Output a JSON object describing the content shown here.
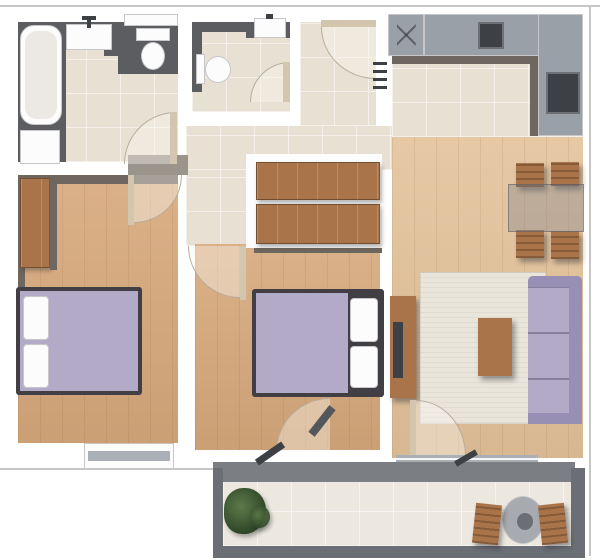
{
  "palette": {
    "plot_line": "#c6c6c6",
    "tile": "#e8e0d3",
    "tile_dark": "#9a948a",
    "wood_living": "#e3c29a",
    "wood_bed": "#d6a87b",
    "shadow": "#5c5d61",
    "shadow_soft": "#6e675f",
    "white_fix": "#fcfcfc",
    "tub_inner": "#ece9e4",
    "appliance_dark": "#3d4146",
    "counter": "#9aa0a8",
    "furn_wood": "#aa744a",
    "bed_frame": "#413f44",
    "purple": "#b2aac7",
    "purple_dark": "#9890b4",
    "rug": "#e9e5da",
    "balcony_floor": "#ece8e0",
    "balc_shadow": "#7b7e83",
    "railing": "#6b6f75",
    "window_gray": "#aab0b6",
    "balc_table": "#a7aaae",
    "door_arc": "#b9ad9c",
    "door_leaf": "#d2c6ae",
    "door_leaf_dark": "#54575b",
    "plant_green": "#3d5a35"
  },
  "scene": {
    "shapes": [
      {
        "name": "plot-line-top",
        "x": 0,
        "y": 5,
        "w": 600,
        "h": 2,
        "fill": "plot_line"
      },
      {
        "name": "plot-line-right",
        "x": 589,
        "y": 5,
        "w": 2,
        "h": 551,
        "fill": "plot_line"
      },
      {
        "name": "plot-line-bottom-left",
        "x": 0,
        "y": 468,
        "w": 214,
        "h": 2,
        "fill": "plot_line"
      },
      {
        "name": "bathroom-floor",
        "x": 18,
        "y": 22,
        "w": 160,
        "h": 140,
        "fill": "tile",
        "cls": "tile"
      },
      {
        "name": "wc-floor",
        "x": 192,
        "y": 22,
        "w": 98,
        "h": 90,
        "fill": "tile",
        "cls": "tile"
      },
      {
        "name": "hall-entry-floor",
        "x": 300,
        "y": 22,
        "w": 76,
        "h": 104,
        "fill": "tile",
        "cls": "tile"
      },
      {
        "name": "hall-mid-floor",
        "x": 186,
        "y": 126,
        "w": 206,
        "h": 44,
        "fill": "tile",
        "cls": "tile"
      },
      {
        "name": "hall-south-floor",
        "x": 186,
        "y": 170,
        "w": 60,
        "h": 76,
        "fill": "tile",
        "cls": "tile"
      },
      {
        "name": "vestibule-floor",
        "x": 128,
        "y": 155,
        "w": 60,
        "h": 20,
        "fill": "tile_dark"
      },
      {
        "name": "kitchen-floor",
        "x": 392,
        "y": 22,
        "w": 191,
        "h": 115,
        "fill": "tile",
        "cls": "tile"
      },
      {
        "name": "living-room-floor",
        "x": 392,
        "y": 137,
        "w": 191,
        "h": 321,
        "fill": "wood_living",
        "cls": "wood-v"
      },
      {
        "name": "bedroom1-floor",
        "x": 18,
        "y": 175,
        "w": 160,
        "h": 268,
        "fill": "wood_bed",
        "cls": "wood-v"
      },
      {
        "name": "bedroom2-floor",
        "x": 195,
        "y": 244,
        "w": 185,
        "h": 206,
        "fill": "wood_bed",
        "cls": "wood-v"
      },
      {
        "name": "bathroom-top-shadow",
        "x": 18,
        "y": 22,
        "w": 160,
        "h": 10,
        "fill": "shadow"
      },
      {
        "name": "bathtub-base-shadow",
        "x": 18,
        "y": 22,
        "w": 48,
        "h": 140,
        "fill": "shadow"
      },
      {
        "name": "sink-nook-shadow",
        "x": 60,
        "y": 22,
        "w": 62,
        "h": 12,
        "fill": "shadow"
      },
      {
        "name": "sink-side-shadow",
        "x": 104,
        "y": 22,
        "w": 18,
        "h": 34,
        "fill": "shadow"
      },
      {
        "name": "toilet-nook-shadow",
        "x": 118,
        "y": 24,
        "w": 60,
        "h": 50,
        "fill": "shadow"
      },
      {
        "name": "toilet-shelf",
        "x": 124,
        "y": 14,
        "w": 54,
        "h": 12,
        "fill": "white_fix",
        "cls": "fixture"
      },
      {
        "name": "wc-top-shadow",
        "x": 192,
        "y": 22,
        "w": 98,
        "h": 10,
        "fill": "shadow"
      },
      {
        "name": "wc-left-shadow",
        "x": 192,
        "y": 22,
        "w": 10,
        "h": 70,
        "fill": "shadow"
      },
      {
        "name": "wc-sink-nook-shadow",
        "x": 246,
        "y": 22,
        "w": 44,
        "h": 16,
        "fill": "shadow"
      },
      {
        "name": "kitchen-counter-shadow",
        "x": 392,
        "y": 54,
        "w": 190,
        "h": 10,
        "fill": "shadow_soft"
      },
      {
        "name": "kitchen-right-shadow",
        "x": 530,
        "y": 54,
        "w": 12,
        "h": 82,
        "fill": "shadow_soft"
      },
      {
        "name": "bedroom1-top-shadow",
        "x": 18,
        "y": 175,
        "w": 160,
        "h": 9,
        "fill": "shadow_soft"
      },
      {
        "name": "bedroom1-left-shadow",
        "x": 18,
        "y": 184,
        "w": 7,
        "h": 110,
        "fill": "shadow_soft"
      },
      {
        "name": "bedroom2-top-shadow",
        "x": 254,
        "y": 246,
        "w": 128,
        "h": 7,
        "fill": "shadow_soft"
      },
      {
        "name": "bathtub",
        "x": 20,
        "y": 25,
        "w": 42,
        "h": 100,
        "fill": "white_fix",
        "cls": "fixture",
        "r": "14px"
      },
      {
        "name": "bathtub-inner",
        "x": 25,
        "y": 31,
        "w": 32,
        "h": 88,
        "fill": "tub_inner",
        "r": "12px"
      },
      {
        "name": "washing-machine",
        "x": 20,
        "y": 130,
        "w": 40,
        "h": 34,
        "fill": "white_fix",
        "cls": "fixture"
      },
      {
        "name": "bathroom-sink",
        "x": 66,
        "y": 24,
        "w": 46,
        "h": 26,
        "fill": "white_fix",
        "cls": "fixture"
      },
      {
        "name": "bathroom-faucet",
        "x": 82,
        "y": 16,
        "w": 14,
        "h": 4,
        "fill": "appliance_dark"
      },
      {
        "name": "bathroom-faucet-stem",
        "x": 87,
        "y": 20,
        "w": 4,
        "h": 8,
        "fill": "appliance_dark"
      },
      {
        "name": "toilet-tank",
        "x": 136,
        "y": 28,
        "w": 34,
        "h": 13,
        "fill": "white_fix",
        "cls": "fixture"
      },
      {
        "name": "toilet-bowl",
        "x": 141,
        "y": 42,
        "w": 24,
        "h": 28,
        "fill": "white_fix",
        "cls": "fixture",
        "r": "50%"
      },
      {
        "name": "wc-toilet-tank",
        "x": 196,
        "y": 54,
        "w": 9,
        "h": 30,
        "fill": "white_fix",
        "cls": "fixture"
      },
      {
        "name": "wc-toilet-bowl",
        "x": 205,
        "y": 56,
        "w": 26,
        "h": 27,
        "fill": "white_fix",
        "cls": "fixture",
        "r": "50%"
      },
      {
        "name": "wc-sink",
        "x": 254,
        "y": 18,
        "w": 32,
        "h": 20,
        "fill": "white_fix",
        "cls": "fixture"
      },
      {
        "name": "wc-faucet",
        "x": 266,
        "y": 14,
        "w": 7,
        "h": 5,
        "fill": "appliance_dark"
      },
      {
        "name": "bathroom-door-arc",
        "x": 124,
        "y": 112,
        "w": 52,
        "h": 52,
        "cls": "arc-tl"
      },
      {
        "name": "bathroom-door-leaf",
        "x": 170,
        "y": 112,
        "w": 7,
        "h": 52,
        "fill": "door_leaf"
      },
      {
        "name": "wc-door-arc",
        "x": 250,
        "y": 62,
        "w": 40,
        "h": 40,
        "cls": "arc-tl"
      },
      {
        "name": "wc-door-leaf",
        "x": 283,
        "y": 62,
        "w": 7,
        "h": 40,
        "fill": "door_leaf"
      },
      {
        "name": "entry-door-leaf",
        "x": 321,
        "y": 20,
        "w": 55,
        "h": 7,
        "fill": "door_leaf"
      },
      {
        "name": "entry-door-arc",
        "x": 321,
        "y": 27,
        "w": 55,
        "h": 52,
        "cls": "arc-bl"
      },
      {
        "name": "hall-wall-hook-1",
        "x": 373,
        "y": 62,
        "w": 14,
        "h": 3,
        "fill": "appliance_dark"
      },
      {
        "name": "hall-wall-hook-2",
        "x": 373,
        "y": 70,
        "w": 14,
        "h": 3,
        "fill": "appliance_dark"
      },
      {
        "name": "hall-wall-hook-3",
        "x": 373,
        "y": 78,
        "w": 14,
        "h": 3,
        "fill": "appliance_dark"
      },
      {
        "name": "hall-wall-hook-4",
        "x": 373,
        "y": 86,
        "w": 14,
        "h": 3,
        "fill": "appliance_dark"
      },
      {
        "name": "bedroom1-door-leaf",
        "x": 128,
        "y": 175,
        "w": 6,
        "h": 50,
        "fill": "door_leaf"
      },
      {
        "name": "bedroom1-door-arc",
        "x": 134,
        "y": 175,
        "w": 48,
        "h": 48,
        "cls": "arc-br"
      },
      {
        "name": "bedroom2-door-leaf",
        "x": 240,
        "y": 246,
        "w": 6,
        "h": 54,
        "fill": "door_leaf"
      },
      {
        "name": "bedroom2-door-arc",
        "x": 188,
        "y": 246,
        "w": 52,
        "h": 52,
        "cls": "arc-bl"
      },
      {
        "name": "fridge-cabinet",
        "x": 388,
        "y": 14,
        "w": 36,
        "h": 42,
        "fill": "counter",
        "cls": "fixture xmark"
      },
      {
        "name": "kitchen-counter-top",
        "x": 424,
        "y": 14,
        "w": 116,
        "h": 42,
        "fill": "counter",
        "cls": "fixture"
      },
      {
        "name": "oven",
        "x": 478,
        "y": 22,
        "w": 26,
        "h": 27,
        "fill": "appliance_dark",
        "cls": "inset"
      },
      {
        "name": "kitchen-counter-right",
        "x": 538,
        "y": 14,
        "w": 45,
        "h": 122,
        "fill": "counter",
        "cls": "fixture"
      },
      {
        "name": "cooktop",
        "x": 546,
        "y": 72,
        "w": 34,
        "h": 42,
        "fill": "appliance_dark",
        "cls": "inset"
      },
      {
        "name": "dining-chair-1",
        "x": 516,
        "y": 163,
        "w": 28,
        "h": 24,
        "fill": "furn_wood",
        "cls": "shadow-br slats"
      },
      {
        "name": "dining-chair-2",
        "x": 551,
        "y": 162,
        "w": 28,
        "h": 24,
        "fill": "furn_wood",
        "cls": "shadow-br slats"
      },
      {
        "name": "dining-chair-3",
        "x": 516,
        "y": 230,
        "w": 28,
        "h": 28,
        "fill": "furn_wood",
        "cls": "shadow-br slats"
      },
      {
        "name": "dining-chair-4",
        "x": 551,
        "y": 231,
        "w": 28,
        "h": 28,
        "fill": "furn_wood",
        "cls": "shadow-br slats"
      },
      {
        "name": "dining-table",
        "x": 508,
        "y": 184,
        "w": 76,
        "h": 48,
        "cls": "glass"
      },
      {
        "name": "tv-stand",
        "x": 390,
        "y": 296,
        "w": 26,
        "h": 102,
        "fill": "furn_wood",
        "cls": "shadow-br"
      },
      {
        "name": "tv",
        "x": 393,
        "y": 322,
        "w": 10,
        "h": 56,
        "fill": "appliance_dark"
      },
      {
        "name": "rug",
        "x": 420,
        "y": 272,
        "w": 126,
        "h": 152,
        "fill": "rug",
        "cls": "rug-tex"
      },
      {
        "name": "coffee-table",
        "x": 478,
        "y": 318,
        "w": 34,
        "h": 58,
        "fill": "furn_wood",
        "cls": "shadow-br"
      },
      {
        "name": "sofa-base",
        "x": 528,
        "y": 276,
        "w": 54,
        "h": 148,
        "fill": "purple",
        "cls": "sofa-seams",
        "r": "5px"
      },
      {
        "name": "sofa-backrest",
        "x": 569,
        "y": 276,
        "w": 13,
        "h": 148,
        "fill": "purple_dark",
        "r": "0 5px 5px 0"
      },
      {
        "name": "sofa-armrest-top",
        "x": 528,
        "y": 276,
        "w": 54,
        "h": 11,
        "fill": "purple_dark",
        "r": "5px 5px 0 0"
      },
      {
        "name": "sofa-armrest-bottom",
        "x": 528,
        "y": 413,
        "w": 54,
        "h": 11,
        "fill": "purple_dark"
      },
      {
        "name": "bedroom1-wardrobe",
        "x": 20,
        "y": 178,
        "w": 30,
        "h": 90,
        "fill": "furn_wood",
        "cls": "ward"
      },
      {
        "name": "bedroom1-wardrobe-shadow",
        "x": 50,
        "y": 180,
        "w": 7,
        "h": 90,
        "fill": "shadow_soft"
      },
      {
        "name": "bed1-frame",
        "x": 16,
        "y": 287,
        "w": 126,
        "h": 108,
        "fill": "bed_frame",
        "r": "3px"
      },
      {
        "name": "bed1-mattress",
        "x": 20,
        "y": 291,
        "w": 118,
        "h": 100,
        "fill": "purple"
      },
      {
        "name": "bed1-pillow-1",
        "x": 23,
        "y": 296,
        "w": 26,
        "h": 44,
        "fill": "white_fix",
        "cls": "fixture",
        "r": "4px"
      },
      {
        "name": "bed1-pillow-2",
        "x": 23,
        "y": 344,
        "w": 26,
        "h": 44,
        "fill": "white_fix",
        "cls": "fixture",
        "r": "4px"
      },
      {
        "name": "bedroom1-window-frame",
        "x": 84,
        "y": 443,
        "w": 90,
        "h": 26,
        "fill": "white_fix",
        "cls": "fixture"
      },
      {
        "name": "bedroom1-window-sash",
        "x": 88,
        "y": 451,
        "w": 82,
        "h": 10,
        "fill": "window_gray"
      },
      {
        "name": "wardrobe-block-wall",
        "x": 246,
        "y": 154,
        "w": 136,
        "h": 94,
        "fill": "white_fix"
      },
      {
        "name": "hall-wardrobe",
        "x": 256,
        "y": 162,
        "w": 124,
        "h": 38,
        "fill": "furn_wood",
        "cls": "ward"
      },
      {
        "name": "bedroom2-wardrobe",
        "x": 256,
        "y": 204,
        "w": 124,
        "h": 40,
        "fill": "furn_wood",
        "cls": "ward"
      },
      {
        "name": "bed2-frame",
        "x": 252,
        "y": 289,
        "w": 132,
        "h": 108,
        "fill": "bed_frame",
        "r": "3px"
      },
      {
        "name": "bed2-mattress",
        "x": 256,
        "y": 293,
        "w": 92,
        "h": 100,
        "fill": "purple"
      },
      {
        "name": "bed2-pillow-1",
        "x": 350,
        "y": 298,
        "w": 28,
        "h": 44,
        "fill": "white_fix",
        "cls": "fixture",
        "r": "4px"
      },
      {
        "name": "bed2-pillow-2",
        "x": 350,
        "y": 346,
        "w": 28,
        "h": 42,
        "fill": "white_fix",
        "cls": "fixture",
        "r": "4px"
      },
      {
        "name": "bedroom2-balcony-door-arc",
        "x": 276,
        "y": 398,
        "w": 54,
        "h": 54,
        "cls": "arc-tl"
      },
      {
        "name": "bedroom2-balcony-door-leaf",
        "x": 318,
        "y": 404,
        "w": 8,
        "h": 34,
        "fill": "door_leaf_dark",
        "rot": 38
      },
      {
        "name": "living-balcony-door-leaf",
        "x": 410,
        "y": 400,
        "w": 6,
        "h": 56,
        "fill": "door_leaf"
      },
      {
        "name": "living-balcony-door-arc",
        "x": 416,
        "y": 400,
        "w": 50,
        "h": 56,
        "cls": "arc-tr"
      },
      {
        "name": "balcony-top-shadow",
        "x": 213,
        "y": 462,
        "w": 362,
        "h": 22,
        "fill": "balc_shadow"
      },
      {
        "name": "balcony-floor",
        "x": 223,
        "y": 482,
        "w": 350,
        "h": 64,
        "fill": "balcony_floor",
        "cls": "tile"
      },
      {
        "name": "balcony-railing-left",
        "x": 213,
        "y": 468,
        "w": 10,
        "h": 90,
        "fill": "railing"
      },
      {
        "name": "balcony-railing-bottom",
        "x": 213,
        "y": 546,
        "w": 372,
        "h": 12,
        "fill": "railing"
      },
      {
        "name": "balcony-railing-right",
        "x": 571,
        "y": 468,
        "w": 14,
        "h": 90,
        "fill": "railing"
      },
      {
        "name": "living-sliding-door",
        "x": 396,
        "y": 455,
        "w": 142,
        "h": 7,
        "fill": "window_gray",
        "cls": "slider"
      },
      {
        "name": "balcony-open-leaf-1",
        "x": 254,
        "y": 450,
        "w": 32,
        "h": 7,
        "fill": "appliance_dark",
        "rot": -35
      },
      {
        "name": "balcony-open-leaf-2",
        "x": 454,
        "y": 455,
        "w": 24,
        "h": 6,
        "fill": "appliance_dark",
        "rot": -30
      },
      {
        "name": "balcony-plant",
        "x": 224,
        "y": 488,
        "w": 42,
        "h": 46,
        "cls": "plant"
      },
      {
        "name": "balcony-plant-small",
        "x": 250,
        "y": 506,
        "w": 20,
        "h": 22,
        "cls": "plant",
        "o": 0.9
      },
      {
        "name": "balcony-table",
        "x": 502,
        "y": 496,
        "w": 42,
        "h": 48,
        "fill": "balc_table",
        "cls": "round fixture"
      },
      {
        "name": "balcony-table-center",
        "x": 517,
        "y": 513,
        "w": 16,
        "h": 17,
        "fill": "railing",
        "cls": "round"
      },
      {
        "name": "balcony-chair-1",
        "x": 474,
        "y": 504,
        "w": 26,
        "h": 40,
        "fill": "furn_wood",
        "cls": "slats shadow-br",
        "rot": 6
      },
      {
        "name": "balcony-chair-2",
        "x": 540,
        "y": 504,
        "w": 26,
        "h": 40,
        "fill": "furn_wood",
        "cls": "slats shadow-br",
        "rot": -6
      }
    ]
  }
}
